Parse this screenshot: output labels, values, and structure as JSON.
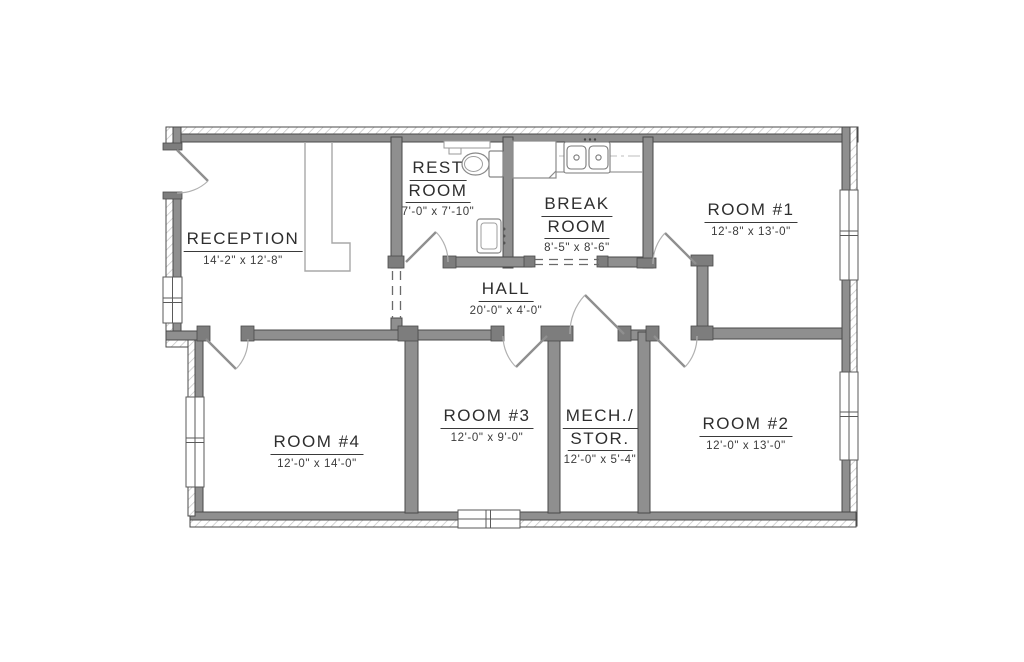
{
  "plan": {
    "rooms": [
      {
        "id": "reception",
        "lines": [
          "RECEPTION"
        ],
        "dims": "14'-2\" x 12'-8\""
      },
      {
        "id": "restroom",
        "lines": [
          "REST",
          "ROOM"
        ],
        "dims": "7'-0\" x 7'-10\""
      },
      {
        "id": "breakroom",
        "lines": [
          "BREAK",
          "ROOM"
        ],
        "dims": "8'-5\" x 8'-6\""
      },
      {
        "id": "room1",
        "lines": [
          "ROOM #1"
        ],
        "dims": "12'-8\" x 13'-0\""
      },
      {
        "id": "hall",
        "lines": [
          "HALL"
        ],
        "dims": "20'-0\" x 4'-0\""
      },
      {
        "id": "room4",
        "lines": [
          "ROOM #4"
        ],
        "dims": "12'-0\" x 14'-0\""
      },
      {
        "id": "room3",
        "lines": [
          "ROOM #3"
        ],
        "dims": "12'-0\" x 9'-0\""
      },
      {
        "id": "mech",
        "lines": [
          "MECH./",
          "STOR."
        ],
        "dims": "12'-0\" x 5'-4\""
      },
      {
        "id": "room2",
        "lines": [
          "ROOM #2"
        ],
        "dims": "12'-0\" x 13'-0\""
      }
    ],
    "fixtures": [
      "toilet",
      "bathroom-sink",
      "shelf",
      "refrigerator",
      "kitchen-double-sink",
      "counter",
      "reception-desk"
    ],
    "colors": {
      "wall_fill": "#8f8f8f",
      "wall_outline": "#4a4a4a",
      "hatch_line": "#c2c2c2",
      "fixture_line": "#8e8e8e",
      "text": "#2e2e2e"
    }
  }
}
